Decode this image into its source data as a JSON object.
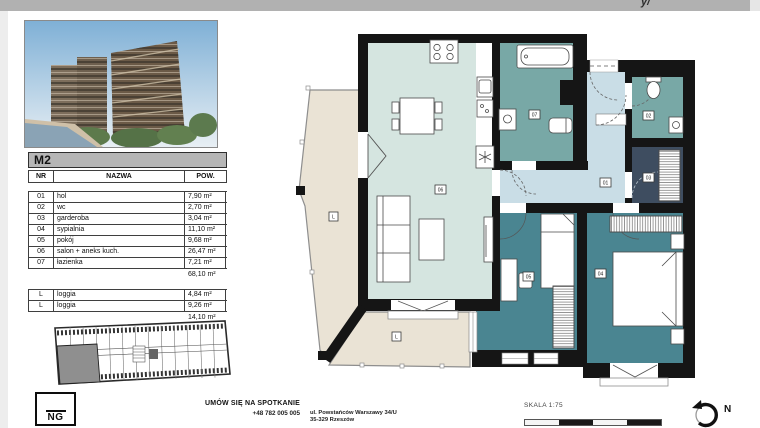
{
  "topbar": {
    "fragment": "y/"
  },
  "unit": {
    "title": "M2"
  },
  "table": {
    "headers": [
      "NR",
      "NAZWA",
      "POW."
    ],
    "rows": [
      [
        "01",
        "hol",
        "7,90 m²"
      ],
      [
        "02",
        "wc",
        "2,70 m²"
      ],
      [
        "03",
        "garderoba",
        "3,04 m²"
      ],
      [
        "04",
        "sypialnia",
        "11,10 m²"
      ],
      [
        "05",
        "pokój",
        "9,68 m²"
      ],
      [
        "06",
        "salon + aneks kuch.",
        "26,47 m²"
      ],
      [
        "07",
        "łazienka",
        "7,21 m²"
      ]
    ],
    "total": "68,10 m²",
    "loggia_rows": [
      [
        "L",
        "loggia",
        "4,84 m²"
      ],
      [
        "L",
        "loggia",
        "9,26 m²"
      ]
    ],
    "loggia_total": "14,10 m²"
  },
  "floorplan": {
    "labels": {
      "r01": "01",
      "r02": "02",
      "r03": "03",
      "r04": "04",
      "r05": "05",
      "r06": "06",
      "r07": "07",
      "loggia_left": "L",
      "loggia_bottom": "L"
    }
  },
  "contact": {
    "cta": "UMÓW SIĘ NA SPOTKANIE",
    "phone": "+48 782 005 005",
    "address_line1": "ul. Powstańców Warszawy 34/U",
    "address_line2": "35-329 Rzeszów"
  },
  "scale": {
    "label": "SKALA 1:75"
  },
  "compass": {
    "label": "N"
  },
  "logo": {
    "text": "NG"
  },
  "colors": {
    "wall": "#151515",
    "salon": "#d5e5e0",
    "hall": "#c9dde6",
    "bathroom": "#78a8a6",
    "bedroom": "#4a8591",
    "wardrobe_room": "#3e4d60",
    "loggia": "#eae3d5",
    "table_header_bg": "#b6b6b6",
    "topbar_bg": "#b1b1b1",
    "scale_dark": "#1a1a1a",
    "scale_light": "#f5f5f5"
  }
}
